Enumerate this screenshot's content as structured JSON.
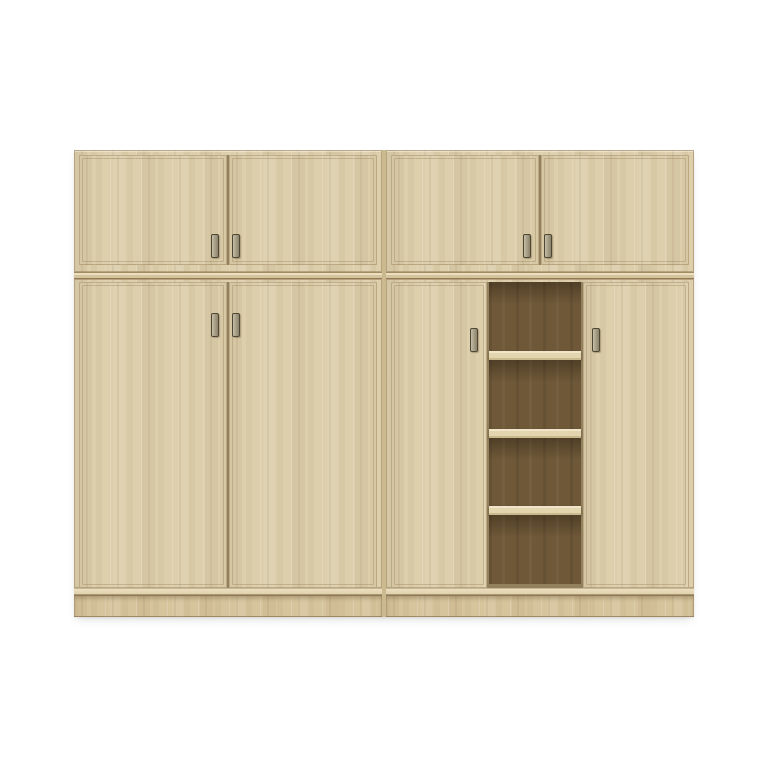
{
  "colors": {
    "background": "#ffffff",
    "wood": "#ddcfac",
    "plinth_wood": "#d6c49c",
    "carcass_line": "#a28b61",
    "divider_dark": "#8f7a55",
    "seam": "#8d7954",
    "door_seam": "#93805c",
    "interior": "#6e5838",
    "shelf_face": "#e3d5ae",
    "handle_face": "#aaa28b",
    "handle_edge": "#4e4734"
  },
  "cabinet": {
    "units": 2,
    "top_section_doors_per_unit": 2,
    "left_unit_bottom_doors": 2,
    "right_unit_bottom_doors": 2,
    "open_shelf_compartments": 4,
    "shelf_boards": 3,
    "handles_total": 8
  }
}
